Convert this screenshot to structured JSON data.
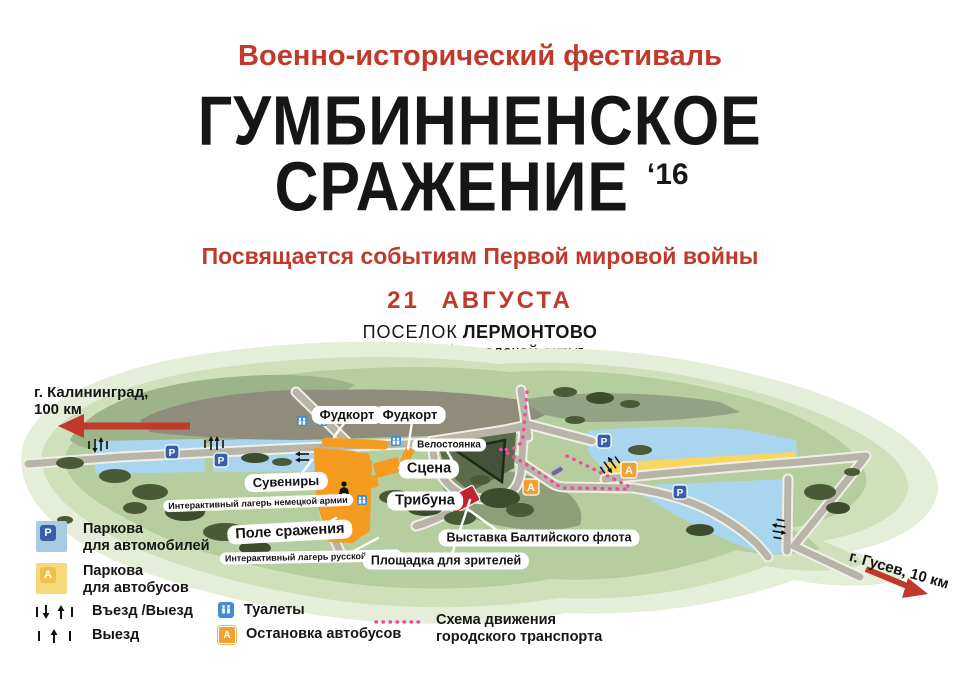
{
  "header": {
    "festival_type": "Военно-исторический фестиваль",
    "title_line1": "ГУМБИННЕНСКОЕ",
    "title_line2": "СРАЖЕНИЕ",
    "title_year": "‘16",
    "dedication": "Посвящается событиям Первой мировой войны",
    "date": "21 АВГУСТА",
    "location_prefix": "ПОСЕЛОК",
    "location_name": "ЛЕРМОНТОВО",
    "district": "Гусевский городской округ"
  },
  "directions": {
    "kaliningrad_line1": "г. Калининград,",
    "kaliningrad_line2": "100 км",
    "gusev": "г. Гусев, 10 км"
  },
  "map": {
    "labels": {
      "foodcourt_1": "Фудкорт",
      "foodcourt_2": "Фудкорт",
      "bike_parking": "Велостоянка",
      "stage": "Сцена",
      "souvenirs": "Сувениры",
      "tribune": "Трибуна",
      "german_camp": "Интерактивный лагерь немецкой армии",
      "battlefield": "Поле сражения",
      "russian_camp": "Интерактивный лагерь русской армии",
      "spectators": "Площадка для зрителей",
      "fleet_exhibition": "Выставка Балтийского флота"
    },
    "icons": {
      "parking_letter": "P",
      "bus_letter": "А"
    }
  },
  "legend": {
    "car_parking_line1": "Паркова",
    "car_parking_line2": "для автомобилей",
    "bus_parking_line1": "Паркова",
    "bus_parking_line2": "для автобусов",
    "entrance_exit": "Въезд /Выезд",
    "exit": "Выезд",
    "toilets": "Туалеты",
    "bus_stop": "Остановка автобусов",
    "transport_route_line1": "Схема движения",
    "transport_route_line2": "городского транспорта"
  },
  "colors": {
    "accent_red": "#c0392b",
    "parking_blue": "#3a5fa8",
    "water_blue": "#a9d6ee",
    "bus_orange": "#f0a134",
    "bus_yellow": "#f6d861",
    "route_pink": "#e8519e",
    "site_orange": "#f49b20",
    "exhibit_red": "#c22333"
  }
}
